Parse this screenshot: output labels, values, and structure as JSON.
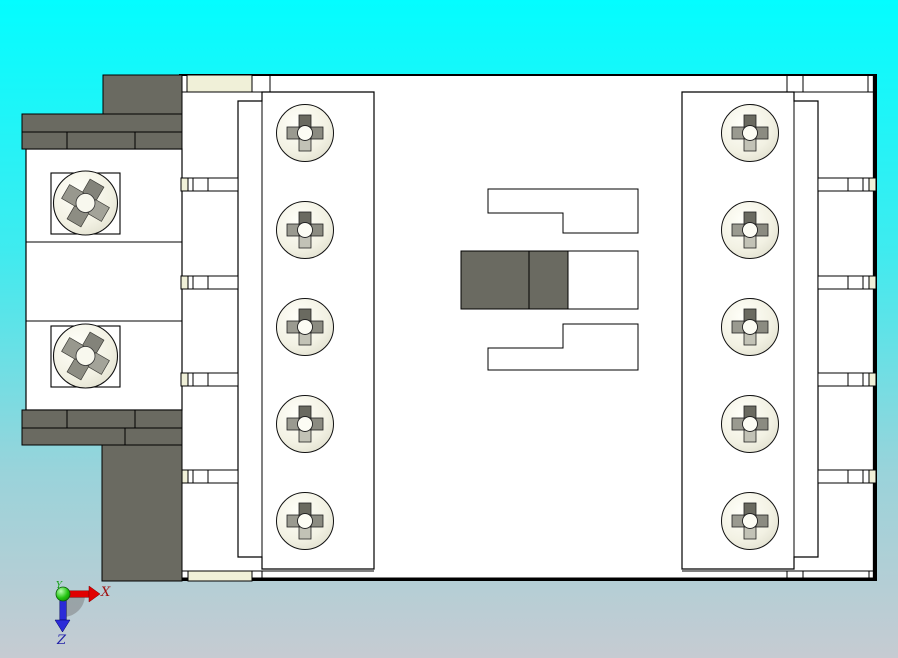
{
  "triad": {
    "x_label": "X",
    "y_label": "Y",
    "z_label": "Z"
  },
  "part": {
    "left_terminal_screw_count": 5,
    "right_terminal_screw_count": 5,
    "mounting_screw_count": 2
  },
  "colors": {
    "bg_top": "#03FDFF",
    "bg_upper": "#3FEBEF",
    "bg_lower": "#9AD3DA",
    "bg_bottom": "#C6CBD2",
    "part_white": "#FFFFFF",
    "outline": "#000000",
    "dark_gray": "#6A6A61",
    "cream": "#F0F0D8",
    "screw_face_light": "#FFFFF9",
    "screw_face": "#F2F1E3",
    "screw_face_dark": "#DBDAC8",
    "slot_dark": "#6A6A60",
    "slot_left": "#9A9A90",
    "slot_right": "#8B8B81",
    "slot_light": "#C2C2B6",
    "slot_center": "#FCFCF4",
    "mslot_top": "#83837A",
    "mslot_right": "#A3A399",
    "mslot_bottom": "#8D8D83",
    "mslot_left": "#98988E",
    "mslot_center": "#F8F8EE",
    "axis_x_red": "#E00000",
    "axis_y_green": "#22C410",
    "axis_z_blue": "#2B2BD8",
    "label_x": "#A01010",
    "label_y": "#12A012",
    "label_z": "#2020A8",
    "shadow_gray": "#7A7A7A",
    "ball_light": "#B8FFB0",
    "ball_dark": "#0E7A06"
  }
}
